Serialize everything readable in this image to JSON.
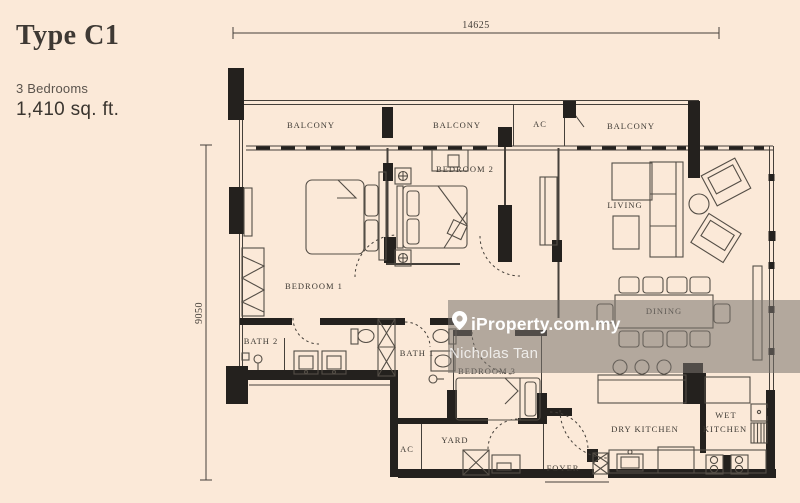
{
  "header": {
    "title": "Type C1",
    "bedrooms": "3 Bedrooms",
    "area": "1,410 sq. ft."
  },
  "dimensions": {
    "top": "14625",
    "left": "9050"
  },
  "rooms": {
    "balcony1": "BALCONY",
    "balcony2": "BALCONY",
    "balcony3": "BALCONY",
    "ac_upper": "AC",
    "ac_lower": "AC",
    "bedroom1": "BEDROOM 1",
    "bedroom2": "BEDROOM 2",
    "bedroom3": "BEDROOM 3",
    "living": "LIVING",
    "dining": "DINING",
    "bath1": "BATH 1",
    "bath2": "BATH 2",
    "dry_kitchen": "DRY KITCHEN",
    "wet_kitchen_line1": "WET",
    "wet_kitchen_line2": "KITCHEN",
    "yard": "YARD",
    "foyer": "FOYER"
  },
  "watermark": {
    "brand": "iProperty.com.my",
    "agent": "Nicholas Tan"
  },
  "colors": {
    "background": "#fbe9d8",
    "wall": "#24211e",
    "label_text": "#3d3933",
    "watermark_overlay": "rgba(120,115,110,0.55)"
  }
}
